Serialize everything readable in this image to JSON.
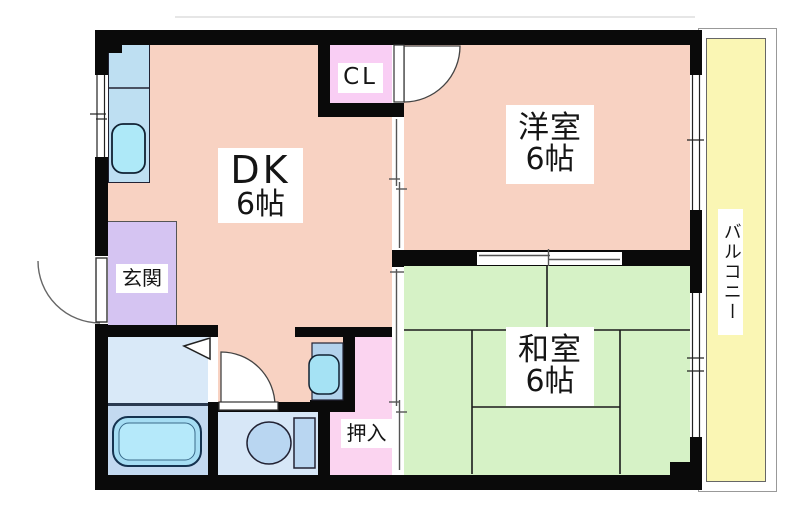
{
  "plan_type": "floorplan-2dk",
  "rooms": {
    "dk": {
      "name": "DK",
      "size": "6帖"
    },
    "western": {
      "name": "洋室",
      "size": "6帖"
    },
    "japanese": {
      "name": "和室",
      "size": "6帖"
    },
    "closet": {
      "name": "CL"
    },
    "entrance": {
      "name": "玄関"
    },
    "oshiire": {
      "name": "押入"
    },
    "balcony": {
      "name": "バルコニー"
    }
  },
  "palette": {
    "wall_black": "#0a0a0a",
    "room_salmon": "#f8d2c2",
    "tatami_green": "#d6f2c6",
    "balcony_yellow": "#faf6b4",
    "closet_pink": "#f9cef4",
    "oshiire_pink": "#fbd4f0",
    "entrance_lavender": "#d5c4f2",
    "kitchen_blue": "#bedff2",
    "washroom_blue": "#d9e9f8",
    "bathroom_blue": "#c3d9f0",
    "toilet_room_blue": "#d7e7f7",
    "fixture_cyan": "#a5e2f4"
  }
}
